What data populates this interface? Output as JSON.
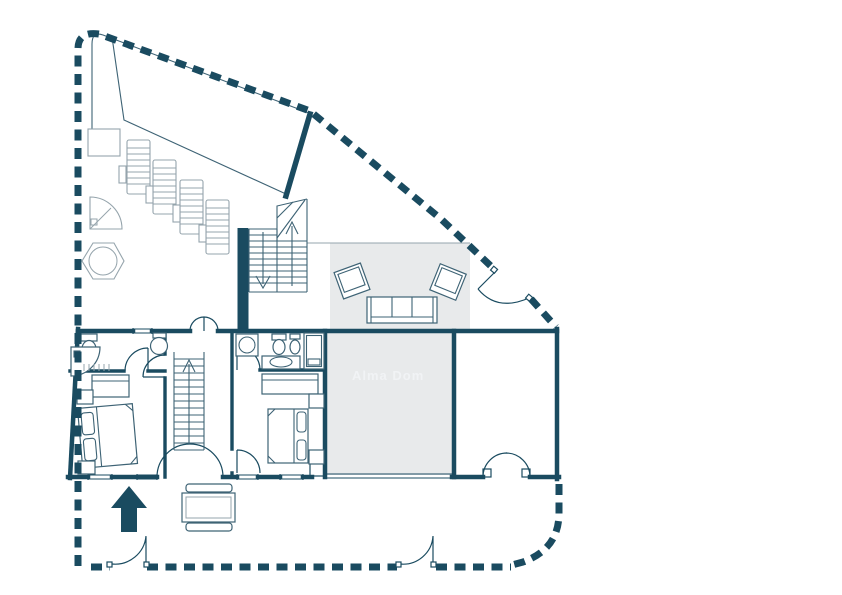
{
  "canvas": {
    "width": 842,
    "height": 595,
    "background": "#ffffff"
  },
  "palette": {
    "wall": "#1a4b60",
    "furniture": "#3e6375",
    "light_furniture": "#95a4ac",
    "area_fill": "#e8eaeb",
    "watermark_text_color": "#f1f3f5"
  },
  "watermark": {
    "text": "Alma Dom"
  },
  "plan": {
    "type": "floor-plan",
    "style": "architectural-2d",
    "elements": [
      "dashed-property-boundary",
      "roof-outline-band",
      "sun-loungers-4",
      "lounger-side-tables",
      "planter-box",
      "outdoor-corner-shower",
      "hexagonal-table",
      "outdoor-double-staircase-with-arrows",
      "living-terrace-rug-with-sofa-and-armchairs",
      "bedroom-1-with-ensuite",
      "bedroom-2-with-ensuite",
      "hall-staircase-up",
      "gray-room-with-watermark",
      "right-room-with-french-door",
      "patio-table-with-benches",
      "entrance-arrow",
      "boundary-gates-3"
    ]
  }
}
